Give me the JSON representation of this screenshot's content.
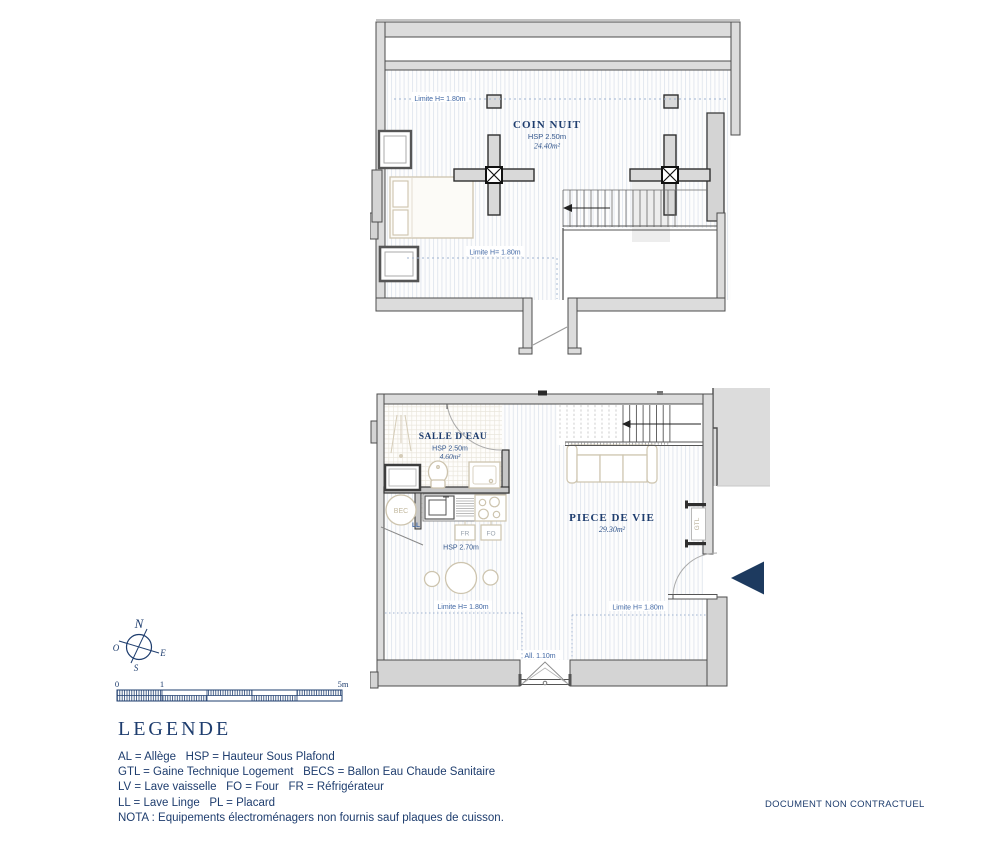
{
  "upper_plan": {
    "room": {
      "name": "COIN NUIT",
      "hsp": "HSP 2.50m",
      "area": "24.40m²"
    },
    "limit_top": "Limite H= 1.80m",
    "limit_bottom": "Limite H= 1.80m"
  },
  "lower_plan": {
    "bathroom": {
      "name": "SALLE D'EAU",
      "hsp": "HSP 2.50m",
      "area": "4.60m²"
    },
    "living": {
      "name": "PIECE DE VIE",
      "area": "29.30m²"
    },
    "kitchen": {
      "hsp": "HSP 2.70m",
      "fr": "FR",
      "fo": "FO"
    },
    "bec": "BEC",
    "ll": "LL",
    "gtl": "GTL",
    "limit_left": "Limite H= 1.80m",
    "limit_right": "Limite H= 1.80m",
    "allege": "All. 1.10m"
  },
  "compass": {
    "north": "N",
    "south": "S",
    "east": "E",
    "west": "O"
  },
  "scale_bar": {
    "start": "0",
    "one": "1",
    "end": "5m"
  },
  "legend": {
    "title": "LEGENDE",
    "lines": [
      "AL = Allège   HSP = Hauteur Sous Plafond",
      "GTL = Gaine Technique Logement   BECS = Ballon Eau Chaude Sanitaire",
      "LV = Lave vaisselle   FO = Four   FR = Réfrigérateur",
      "LL = Lave Linge   PL = Placard",
      "NOTA : Equipements électroménagers non fournis sauf plaques de cuisson."
    ]
  },
  "footer": {
    "note": "DOCUMENT NON CONTRACTUEL"
  }
}
